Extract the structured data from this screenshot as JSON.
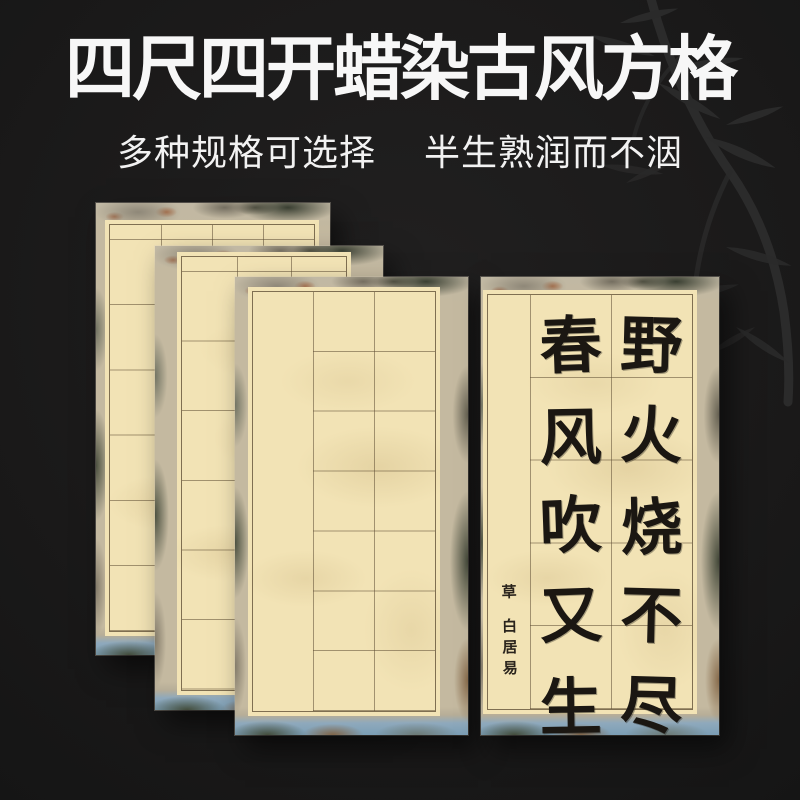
{
  "header": {
    "title": "四尺四开蜡染古风方格",
    "subtitle_left": "多种规格可选择",
    "subtitle_right": "半生熟润而不洇"
  },
  "decor": {
    "bamboo_icon": "bamboo-silhouette-top-right"
  },
  "colors": {
    "background": "#1b1a1a",
    "title_text": "#f7f7f7",
    "paper_cream": "#f2e3b5",
    "grid_line": "#5f4e34",
    "ink": "#1b1712",
    "water_blue": "#7b9eb5",
    "bamboo_silhouette": "#2c2c2c"
  },
  "product": {
    "sheets": [
      {
        "id": "back",
        "type": "blank-grid",
        "grid_columns": 4,
        "grid_rows": 6
      },
      {
        "id": "middle",
        "type": "blank-grid",
        "grid_columns": 3,
        "grid_rows": 6
      },
      {
        "id": "front",
        "type": "blank-grid",
        "grid_columns": 2,
        "grid_rows": 7,
        "signature_column": true
      },
      {
        "id": "calligraphy",
        "type": "calligraphy-demo",
        "grid_columns": 2,
        "grid_rows": 5,
        "signature_column": true
      }
    ],
    "calligraphy": {
      "right_column_chars": [
        "野",
        "火",
        "烧",
        "不",
        "尽"
      ],
      "left_column_chars": [
        "春",
        "风",
        "吹",
        "又",
        "生"
      ],
      "poem_lines": [
        "野火烧不尽",
        "春风吹又生"
      ],
      "signature_title": "草",
      "signature_author": "白居易"
    }
  }
}
